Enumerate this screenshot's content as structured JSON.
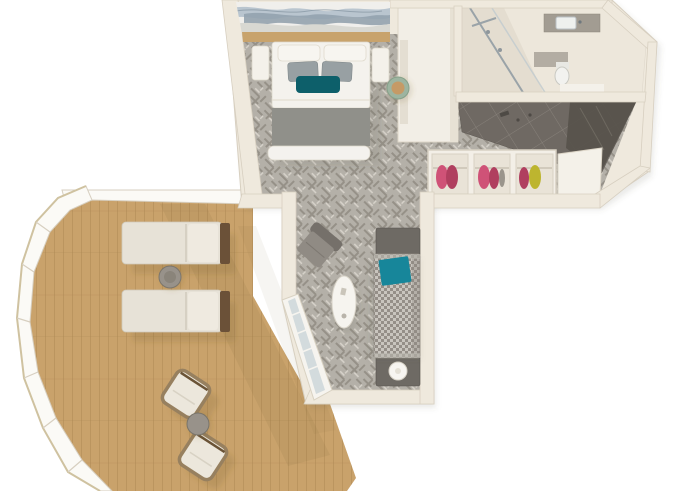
{
  "meta": {
    "title": "3D floor plan rendering - suite with wraparound balcony",
    "view": "top-down isometric cutaway"
  },
  "colors": {
    "background": "#ffffff",
    "wall": "#efe9dd",
    "wallEdge": "#d7cfc0",
    "baseShadow": "rgba(90,80,65,0.12)",
    "carpet": "#b4b0a8",
    "carpetDark": "#8e897f",
    "carpetLight": "#dcd8d0",
    "deck": "#c9a26b",
    "deckLine": "#a8834e",
    "deckShadow": "rgba(115,88,50,0.18)",
    "railing": "#fbfaf6",
    "railTrim": "#cfc2a0",
    "entryFloor": "#6f6963",
    "entryGrout": "#8d8780",
    "entryPanel": "#57524b",
    "bathFloor": "#ede7db",
    "showerFloor": "#e4ddd0",
    "counter": "#a29c92",
    "chrome": "#9aa3a8",
    "glass": "#ccd6d9",
    "bedWhite": "#f4f2ed",
    "bedFoot": "#90908a",
    "pillowWhite": "#f7f5f0",
    "pillowGray": "#98a0a3",
    "tealPillow": "#0d5f6a",
    "wood": "#c8a36c",
    "art1": "#b9c5cf",
    "art2": "#93a2ae",
    "art3": "#d8d8d2",
    "stool": "#9db4a0",
    "stoolTop": "#c59a66",
    "clothesPink": "#cf5277",
    "clothesRed": "#b03f5f",
    "clothesYellow": "#bdb52f",
    "sofaBase": "#c9c5be",
    "sofaCheck": "#8f8a82",
    "sofaTeal": "#17869a",
    "tableDark": "#6e6a64",
    "lamp": "#f7f5f1",
    "loungerCushion": "#e7e2d7",
    "loungerBack": "#efeae0",
    "loungerFrame": "#6b5138",
    "wicker": "#97805f",
    "chairCushion": "#ece7dc",
    "sideTable": "#98928a"
  },
  "rooms": [
    {
      "id": "bedroom",
      "label": "Bedroom",
      "items": [
        "double bed",
        "white pillows",
        "grey pillows",
        "teal accent pillow",
        "foot bench",
        "left nightstand",
        "right nightstand",
        "wavy wall artwork",
        "closet unit",
        "round green stool"
      ]
    },
    {
      "id": "bathroom",
      "label": "Bathroom",
      "items": [
        "walk-in shower with glass panel",
        "vanity counter with sink",
        "toilet",
        "bath mat"
      ]
    },
    {
      "id": "entry",
      "label": "Entry hall",
      "items": [
        "dark tile floor",
        "wardrobe bay with pink clothes",
        "wardrobe bay with pink and red clothes",
        "wardrobe bay with yellow clothes",
        "door mat"
      ]
    },
    {
      "id": "living-room",
      "label": "Living room",
      "items": [
        "patterned sofa",
        "teal throw",
        "side table",
        "side table with round lamp",
        "grey armchair",
        "oval coffee table",
        "sliding glass balcony door"
      ]
    },
    {
      "id": "balcony",
      "label": "Wraparound balcony",
      "items": [
        "timber deck",
        "curved white railing",
        "sun lounger",
        "sun lounger",
        "round side table",
        "lounge chair",
        "lounge chair",
        "bistro table"
      ]
    }
  ]
}
